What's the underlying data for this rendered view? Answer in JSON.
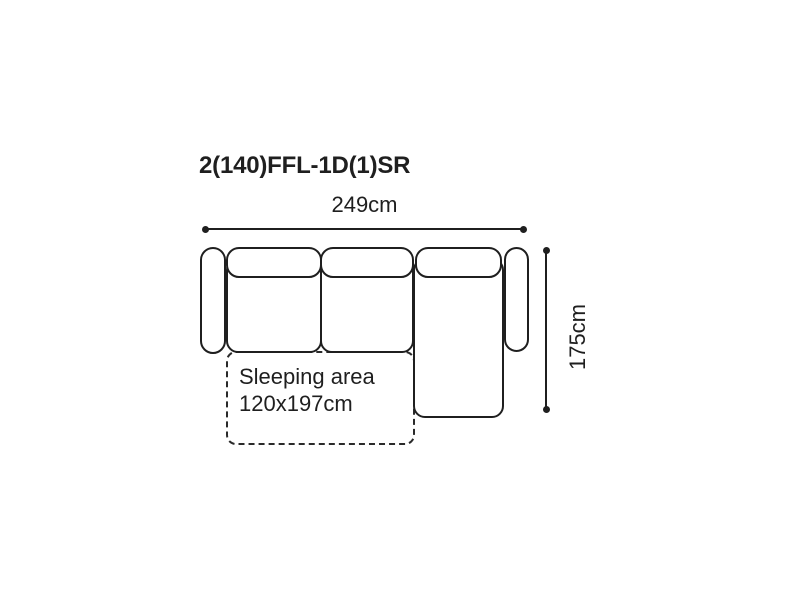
{
  "product": {
    "title": "2(140)FFL-1D(1)SR"
  },
  "dimensions": {
    "width_label": "249cm",
    "depth_label": "175cm"
  },
  "sleeping_area": {
    "line1": "Sleeping area",
    "line2": "120x197cm"
  },
  "diagram": {
    "type": "sofa-top-view",
    "parts": [
      "left-armrest",
      "seat-section-1",
      "seat-section-2",
      "chaise-section",
      "right-armrest",
      "backrest-cushion-1",
      "backrest-cushion-2",
      "chaise-backrest-cushion",
      "sleeping-area-outline"
    ]
  },
  "colors": {
    "line": "#1f1f1f",
    "text": "#1f1f1f",
    "background": "#ffffff"
  }
}
